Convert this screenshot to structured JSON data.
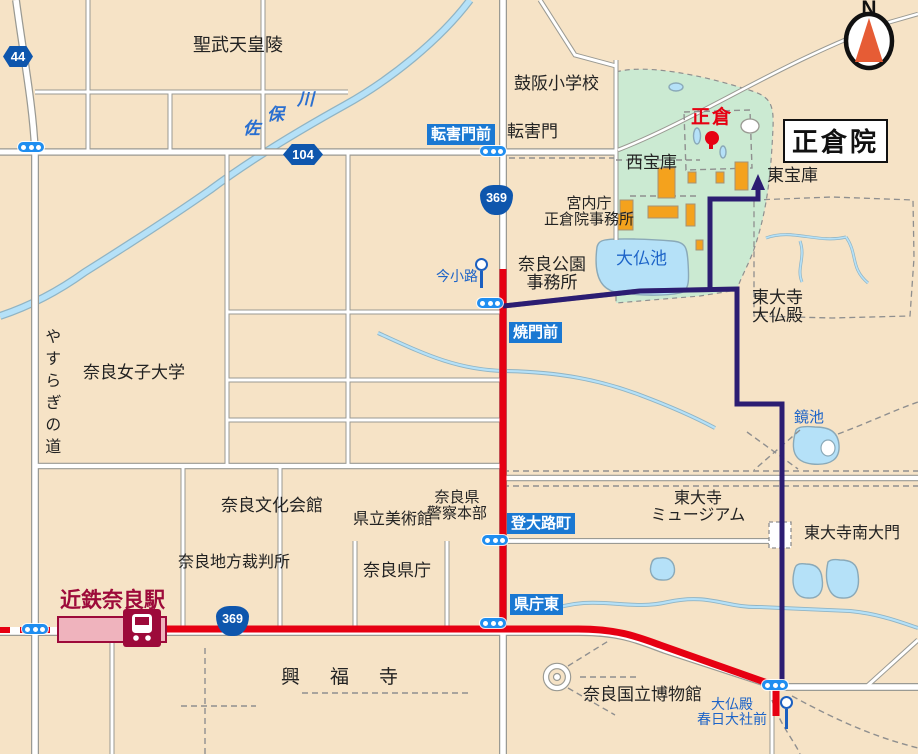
{
  "map_title": "正倉院周辺案内図",
  "labels": {
    "compass_n": "N",
    "title": "正倉院",
    "shomu_tomb": "聖武天皇陵",
    "tsuzumisaka_school": "鼓阪小学校",
    "tegai_gate": "転害門",
    "saho_river": [
      "佐",
      "保",
      "川"
    ],
    "imperial_office_line1": "宮内庁",
    "imperial_office_line2": "正倉院事務所",
    "west_treasury": "西宝庫",
    "east_treasury": "東宝庫",
    "shoso": "正倉",
    "park_office_line1": "奈良公園",
    "park_office_line2": "事務所",
    "daibutsu_pond": "大仏池",
    "daibutsuden_line1": "東大寺",
    "daibutsuden_line2": "大仏殿",
    "yasuragi_road": "やすらぎの道",
    "nara_womens_univ": "奈良女子大学",
    "kagami_pond": "鏡池",
    "culture_hall": "奈良文化会館",
    "pref_art_museum": "県立美術館",
    "police_line1": "奈良県",
    "police_line2": "警察本部",
    "district_court": "奈良地方裁判所",
    "pref_office": "奈良県庁",
    "kintetsu_nara_station": "近鉄奈良駅",
    "kofukuji": "興福寺",
    "national_museum": "奈良国立博物館",
    "todaiji_museum_line1": "東大寺",
    "todaiji_museum_line2": "ミュージアム",
    "nandaimon": "東大寺南大門"
  },
  "bus_stops": {
    "tegaimon_mae": "転害門前",
    "yakimon_mae": "焼門前",
    "noborioji_cho": "登大路町",
    "kencho_higashi": "県庁東",
    "imakoji": "今小路",
    "daibutsuden_kasuga_line1": "大仏殿",
    "daibutsuden_kasuga_line2": "春日大社前"
  },
  "road_badges": {
    "pref_44": "44",
    "pref_104": "104",
    "national_369_north": "369",
    "national_369_south": "369"
  },
  "icons": {
    "compass": "compass-north-icon",
    "traffic_signal": "traffic-light-icon",
    "bus_stop_pole": "bus-stop-pole-icon",
    "train_station": "train-icon",
    "shoso_marker": "red-dot-marker",
    "route_arrow": "walking-route-arrow"
  },
  "colors": {
    "background": "#f6e3c6",
    "park_green": "#cbead2",
    "water_blue": "#b5e1f8",
    "bus_route_red": "#e60012",
    "walking_route_navy": "#2c1d72",
    "bus_stop_label_blue": "#1a78d2",
    "badge_blue": "#0e56ad",
    "station_dark_red": "#9d0a3a",
    "building_orange": "#f4a21d"
  }
}
